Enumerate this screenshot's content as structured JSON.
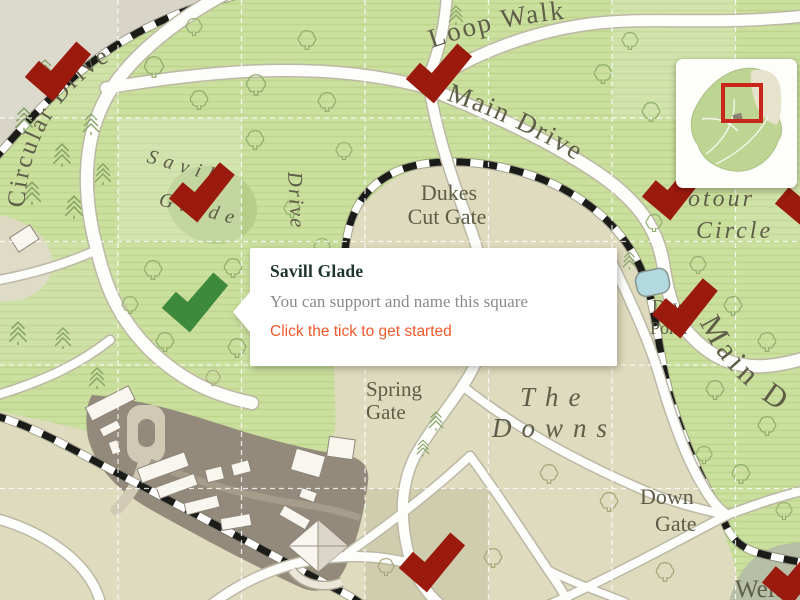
{
  "popup": {
    "title": "Savill Glade",
    "body": "You can support and name this square",
    "cta": "Click the tick to get started"
  },
  "labels": {
    "circular_drive": "Circular Drive",
    "drive_vertical": "Drive",
    "savill": "Savill",
    "glade": "Glade",
    "loop_walk": "Loop Walk",
    "main_drive": "Main Drive",
    "dukes": "Dukes",
    "cut_gate": "Cut Gate",
    "circle_top": "otour",
    "circle_bottom": "Circle",
    "dew": "Dew",
    "pond": "Pond",
    "main_drive_east": "Main D",
    "spring": "Spring",
    "spring_gate": "Gate",
    "the": "The",
    "downs": "Downs",
    "down": "Down",
    "down_gate": "Gate",
    "welcome": "Welco"
  },
  "colors": {
    "tick_supported": "#9b1a0e",
    "tick_available": "#3e8a3c",
    "cta_orange": "#f05a2b",
    "label_ink": "#5e5d48",
    "welcome_ink": "#a9ac48",
    "minimap_viewport": "#c9261b"
  },
  "ticks": {
    "supported_count": 8,
    "available_count": 1,
    "highlighted_square": "Savill Glade"
  }
}
